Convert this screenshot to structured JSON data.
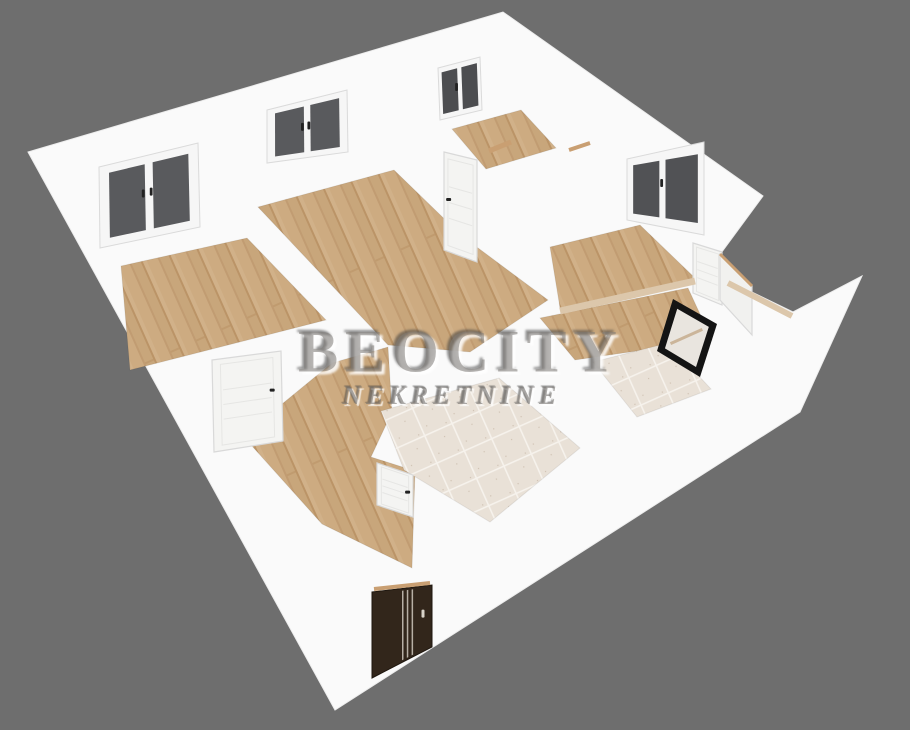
{
  "watermark": {
    "title": "BEOCITY",
    "subtitle": "NEKRETNINE"
  },
  "colors": {
    "background": "#6e6e6e",
    "wall": "#fafafa",
    "wallEdge": "#ededed",
    "woodA": "#cdab81",
    "woodB": "#c19c72",
    "woodC": "#c8a67b",
    "woodD": "#bb9467",
    "woodE": "#d1b189",
    "tile": "#e9e1d7",
    "tileLine": "#f6f2ec",
    "tileSpeck": "#b9a893",
    "frame": "#f6f6f6",
    "frameEdge": "#dadada",
    "doorWhite": "#f4f4f2",
    "doorEdge": "#d9d9d9",
    "doorGroove": "#e6e6e4",
    "handleDark": "#222222",
    "entryDoor": "#32261b",
    "entryStripe": "#cfc8bd",
    "entryHandle": "#d8d3c9",
    "tan": "#c99f72",
    "parapetTan": "#dcc7ab",
    "blackFrame": "#141414",
    "blackInner": "#e9e5df",
    "blackAccent": "#cbb59a"
  },
  "scene": {
    "silhouette": [
      [
        28,
        152
      ],
      [
        503,
        12
      ],
      [
        763,
        196
      ],
      [
        713,
        264
      ],
      [
        727,
        280
      ],
      [
        793,
        312
      ],
      [
        862,
        276
      ],
      [
        800,
        412
      ],
      [
        335,
        710
      ]
    ],
    "floors": [
      {
        "name": "floor-bedroom-left",
        "material": "wood",
        "points": [
          [
            121,
            266
          ],
          [
            247,
            238
          ],
          [
            326,
            320
          ],
          [
            130,
            370
          ]
        ]
      },
      {
        "name": "floor-room-middle",
        "material": "wood",
        "points": [
          [
            258,
            207
          ],
          [
            394,
            170
          ],
          [
            462,
            236
          ],
          [
            548,
            300
          ],
          [
            470,
            352
          ],
          [
            388,
            345
          ]
        ]
      },
      {
        "name": "floor-room-top-small",
        "material": "wood",
        "points": [
          [
            452,
            129
          ],
          [
            521,
            110
          ],
          [
            556,
            148
          ],
          [
            486,
            169
          ]
        ]
      },
      {
        "name": "floor-room-right",
        "material": "wood",
        "points": [
          [
            550,
            247
          ],
          [
            640,
            225
          ],
          [
            695,
            278
          ],
          [
            560,
            308
          ]
        ]
      },
      {
        "name": "floor-room-right-lower",
        "material": "wood",
        "points": [
          [
            540,
            318
          ],
          [
            688,
            288
          ],
          [
            712,
            340
          ],
          [
            575,
            360
          ]
        ]
      },
      {
        "name": "floor-hallway",
        "material": "wood",
        "points": [
          [
            243,
            436
          ],
          [
            332,
            363
          ],
          [
            388,
            347
          ],
          [
            392,
            412
          ],
          [
            371,
            457
          ],
          [
            415,
            471
          ],
          [
            412,
            568
          ],
          [
            322,
            524
          ]
        ]
      },
      {
        "name": "floor-bathroom",
        "material": "tile",
        "points": [
          [
            381,
            411
          ],
          [
            499,
            378
          ],
          [
            580,
            448
          ],
          [
            490,
            522
          ],
          [
            404,
            470
          ]
        ]
      },
      {
        "name": "floor-toilet",
        "material": "tile",
        "points": [
          [
            593,
            362
          ],
          [
            668,
            343
          ],
          [
            711,
            389
          ],
          [
            637,
            417
          ]
        ]
      }
    ],
    "windows": [
      {
        "name": "window-1",
        "quad": [
          [
            99,
            167
          ],
          [
            198,
            143
          ],
          [
            200,
            227
          ],
          [
            100,
            248
          ]
        ],
        "pane": "#595a5d",
        "panes": [
          [
            0.1,
            0.1,
            0.46,
            0.9
          ],
          [
            0.54,
            0.1,
            0.9,
            0.9
          ]
        ],
        "handles": [
          [
            0.44,
            0.45
          ],
          [
            0.52,
            0.45
          ]
        ]
      },
      {
        "name": "window-2",
        "quad": [
          [
            267,
            110
          ],
          [
            347,
            90
          ],
          [
            348,
            152
          ],
          [
            267,
            163
          ]
        ],
        "pane": "#595a5d",
        "panes": [
          [
            0.1,
            0.1,
            0.46,
            0.9
          ],
          [
            0.54,
            0.1,
            0.9,
            0.9
          ]
        ],
        "handles": [
          [
            0.44,
            0.45
          ],
          [
            0.52,
            0.45
          ]
        ]
      },
      {
        "name": "window-3",
        "quad": [
          [
            438,
            68
          ],
          [
            480,
            57
          ],
          [
            482,
            110
          ],
          [
            440,
            120
          ]
        ],
        "pane": "#4c4d50",
        "panes": [
          [
            0.08,
            0.1,
            0.45,
            0.9
          ],
          [
            0.55,
            0.1,
            0.92,
            0.9
          ]
        ],
        "handles": [
          [
            0.42,
            0.45
          ]
        ]
      },
      {
        "name": "window-4",
        "quad": [
          [
            627,
            159
          ],
          [
            704,
            142
          ],
          [
            704,
            235
          ],
          [
            627,
            220
          ]
        ],
        "pane": "#515255",
        "panes": [
          [
            0.08,
            0.12,
            0.42,
            0.88
          ],
          [
            0.5,
            0.12,
            0.92,
            0.88
          ]
        ],
        "handles": [
          [
            0.45,
            0.42
          ]
        ]
      }
    ],
    "doors": [
      {
        "name": "door-top-room",
        "type": "white",
        "quad": [
          [
            444,
            152
          ],
          [
            477,
            160
          ],
          [
            477,
            262
          ],
          [
            444,
            250
          ]
        ],
        "handle": [
          0.14,
          0.47
        ]
      },
      {
        "name": "door-bedroom",
        "type": "white",
        "quad": [
          [
            212,
            360
          ],
          [
            281,
            351
          ],
          [
            283,
            441
          ],
          [
            214,
            452
          ]
        ],
        "handle": [
          0.86,
          0.42
        ]
      },
      {
        "name": "door-bathroom",
        "type": "white",
        "quad": [
          [
            377,
            463
          ],
          [
            413,
            475
          ],
          [
            413,
            517
          ],
          [
            377,
            505
          ]
        ],
        "handle": [
          0.85,
          0.45
        ]
      },
      {
        "name": "doorway-terrace",
        "type": "white",
        "quad": [
          [
            693,
            243
          ],
          [
            722,
            252
          ],
          [
            722,
            305
          ],
          [
            693,
            293
          ]
        ],
        "handle": null
      },
      {
        "name": "door-terrace-open",
        "type": "panel",
        "quad": [
          [
            720,
            254
          ],
          [
            752,
            286
          ],
          [
            752,
            335
          ],
          [
            720,
            300
          ]
        ],
        "handle": null
      },
      {
        "name": "entrance-door",
        "type": "entry",
        "quad": [
          [
            372,
            592
          ],
          [
            432,
            585
          ],
          [
            432,
            647
          ],
          [
            372,
            678
          ]
        ],
        "handle": [
          0.85,
          0.42
        ]
      }
    ],
    "blackWindow": {
      "name": "window-black-frame",
      "quad": [
        [
          673,
          299
        ],
        [
          717,
          324
        ],
        [
          700,
          377
        ],
        [
          657,
          351
        ]
      ]
    },
    "accents": [
      {
        "name": "lintel-1",
        "from": [
          489,
          151
        ],
        "to": [
          511,
          142
        ],
        "w": 5,
        "color": "tan"
      },
      {
        "name": "lintel-2",
        "from": [
          569,
          150
        ],
        "to": [
          590,
          143
        ],
        "w": 4,
        "color": "tan"
      },
      {
        "name": "threshold-entrance",
        "from": [
          374,
          589
        ],
        "to": [
          430,
          583
        ],
        "w": 4,
        "color": "tan"
      },
      {
        "name": "parapet-top-1",
        "from": [
          560,
          311
        ],
        "to": [
          695,
          281
        ],
        "w": 7,
        "color": "parapetTan"
      },
      {
        "name": "parapet-top-2",
        "from": [
          728,
          283
        ],
        "to": [
          792,
          316
        ],
        "w": 6,
        "color": "parapetTan"
      },
      {
        "name": "door-open-top",
        "from": [
          720,
          254
        ],
        "to": [
          752,
          286
        ],
        "w": 3,
        "color": "tan"
      }
    ]
  }
}
